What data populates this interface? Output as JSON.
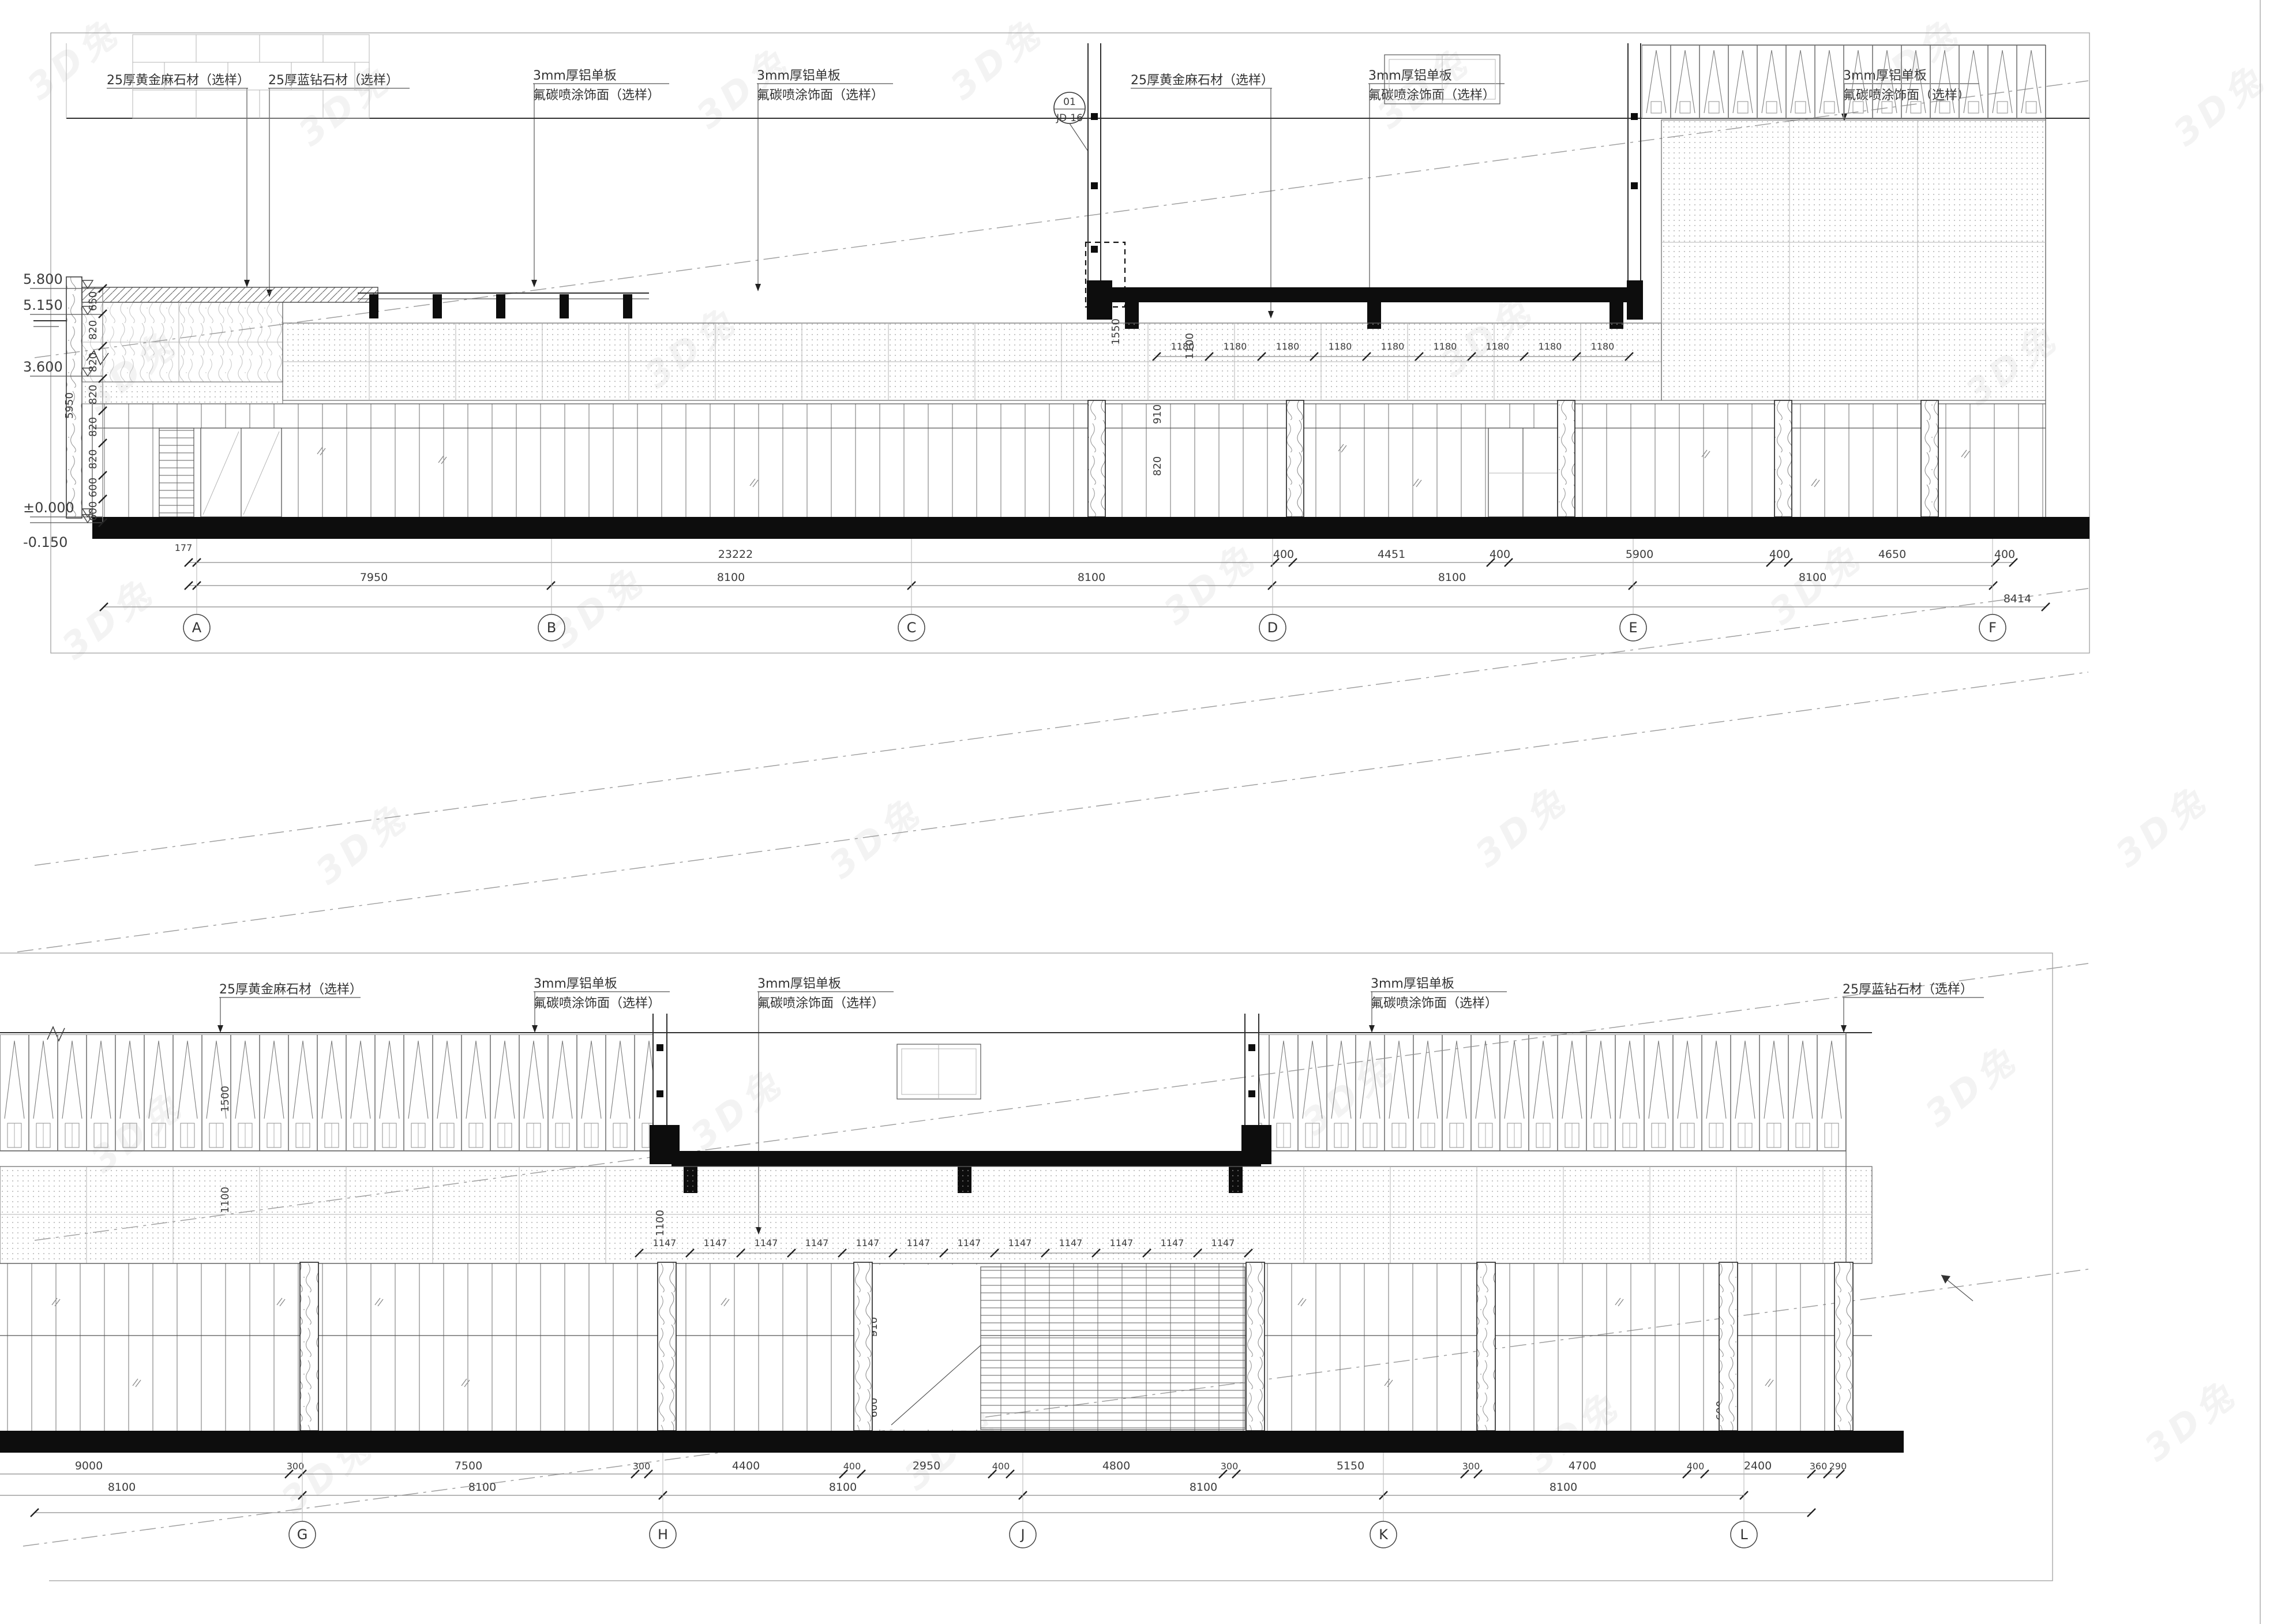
{
  "watermark": {
    "text": "3D兔"
  },
  "annotations": {
    "stone_gold": "25厚黄金麻石材（选样）",
    "stone_blue": "25厚蓝钻石材（选样）",
    "alu1": "3mm厚铝单板",
    "alu2": "氟碳喷涂饰面（选样）",
    "detail_no": "01",
    "detail_sheet": "JD-16"
  },
  "top_elevation": {
    "levels": [
      "5.800",
      "5.150",
      "3.600",
      "±0.000",
      "-0.150"
    ],
    "level_chain": [
      "650",
      "820",
      "820",
      "820",
      "820",
      "820",
      "600",
      "600"
    ],
    "level_chain_total": "5950",
    "band_dims": [
      "1180",
      "1180",
      "1180",
      "1180",
      "1180",
      "1180",
      "1180",
      "1180",
      "1180"
    ],
    "vdims": [
      "1550",
      "1100",
      "910",
      "820"
    ],
    "dim_row1": [
      "177",
      "23222",
      "400",
      "4451",
      "400",
      "5900",
      "400",
      "4650",
      "400"
    ],
    "dim_row2": [
      "7950",
      "8100",
      "8100",
      "8100",
      "8100"
    ],
    "dim_row3_right": "8414",
    "grids": [
      "A",
      "B",
      "C",
      "D",
      "E",
      "F"
    ]
  },
  "bottom_elevation": {
    "band_dims": [
      "1147",
      "1147",
      "1147",
      "1147",
      "1147",
      "1147",
      "1147",
      "1147",
      "1147",
      "1147",
      "1147",
      "1147"
    ],
    "vdims": [
      "1500",
      "1100",
      "1100",
      "910",
      "600",
      "600"
    ],
    "dim_row1": [
      "9000",
      "300",
      "7500",
      "300",
      "4400",
      "400",
      "2950",
      "400",
      "4800",
      "300",
      "5150",
      "300",
      "4700",
      "400",
      "2400",
      "360",
      "290"
    ],
    "dim_row2": [
      "8100",
      "8100",
      "8100",
      "8100",
      "8100"
    ],
    "grids": [
      "G",
      "H",
      "J",
      "K",
      "L"
    ]
  }
}
